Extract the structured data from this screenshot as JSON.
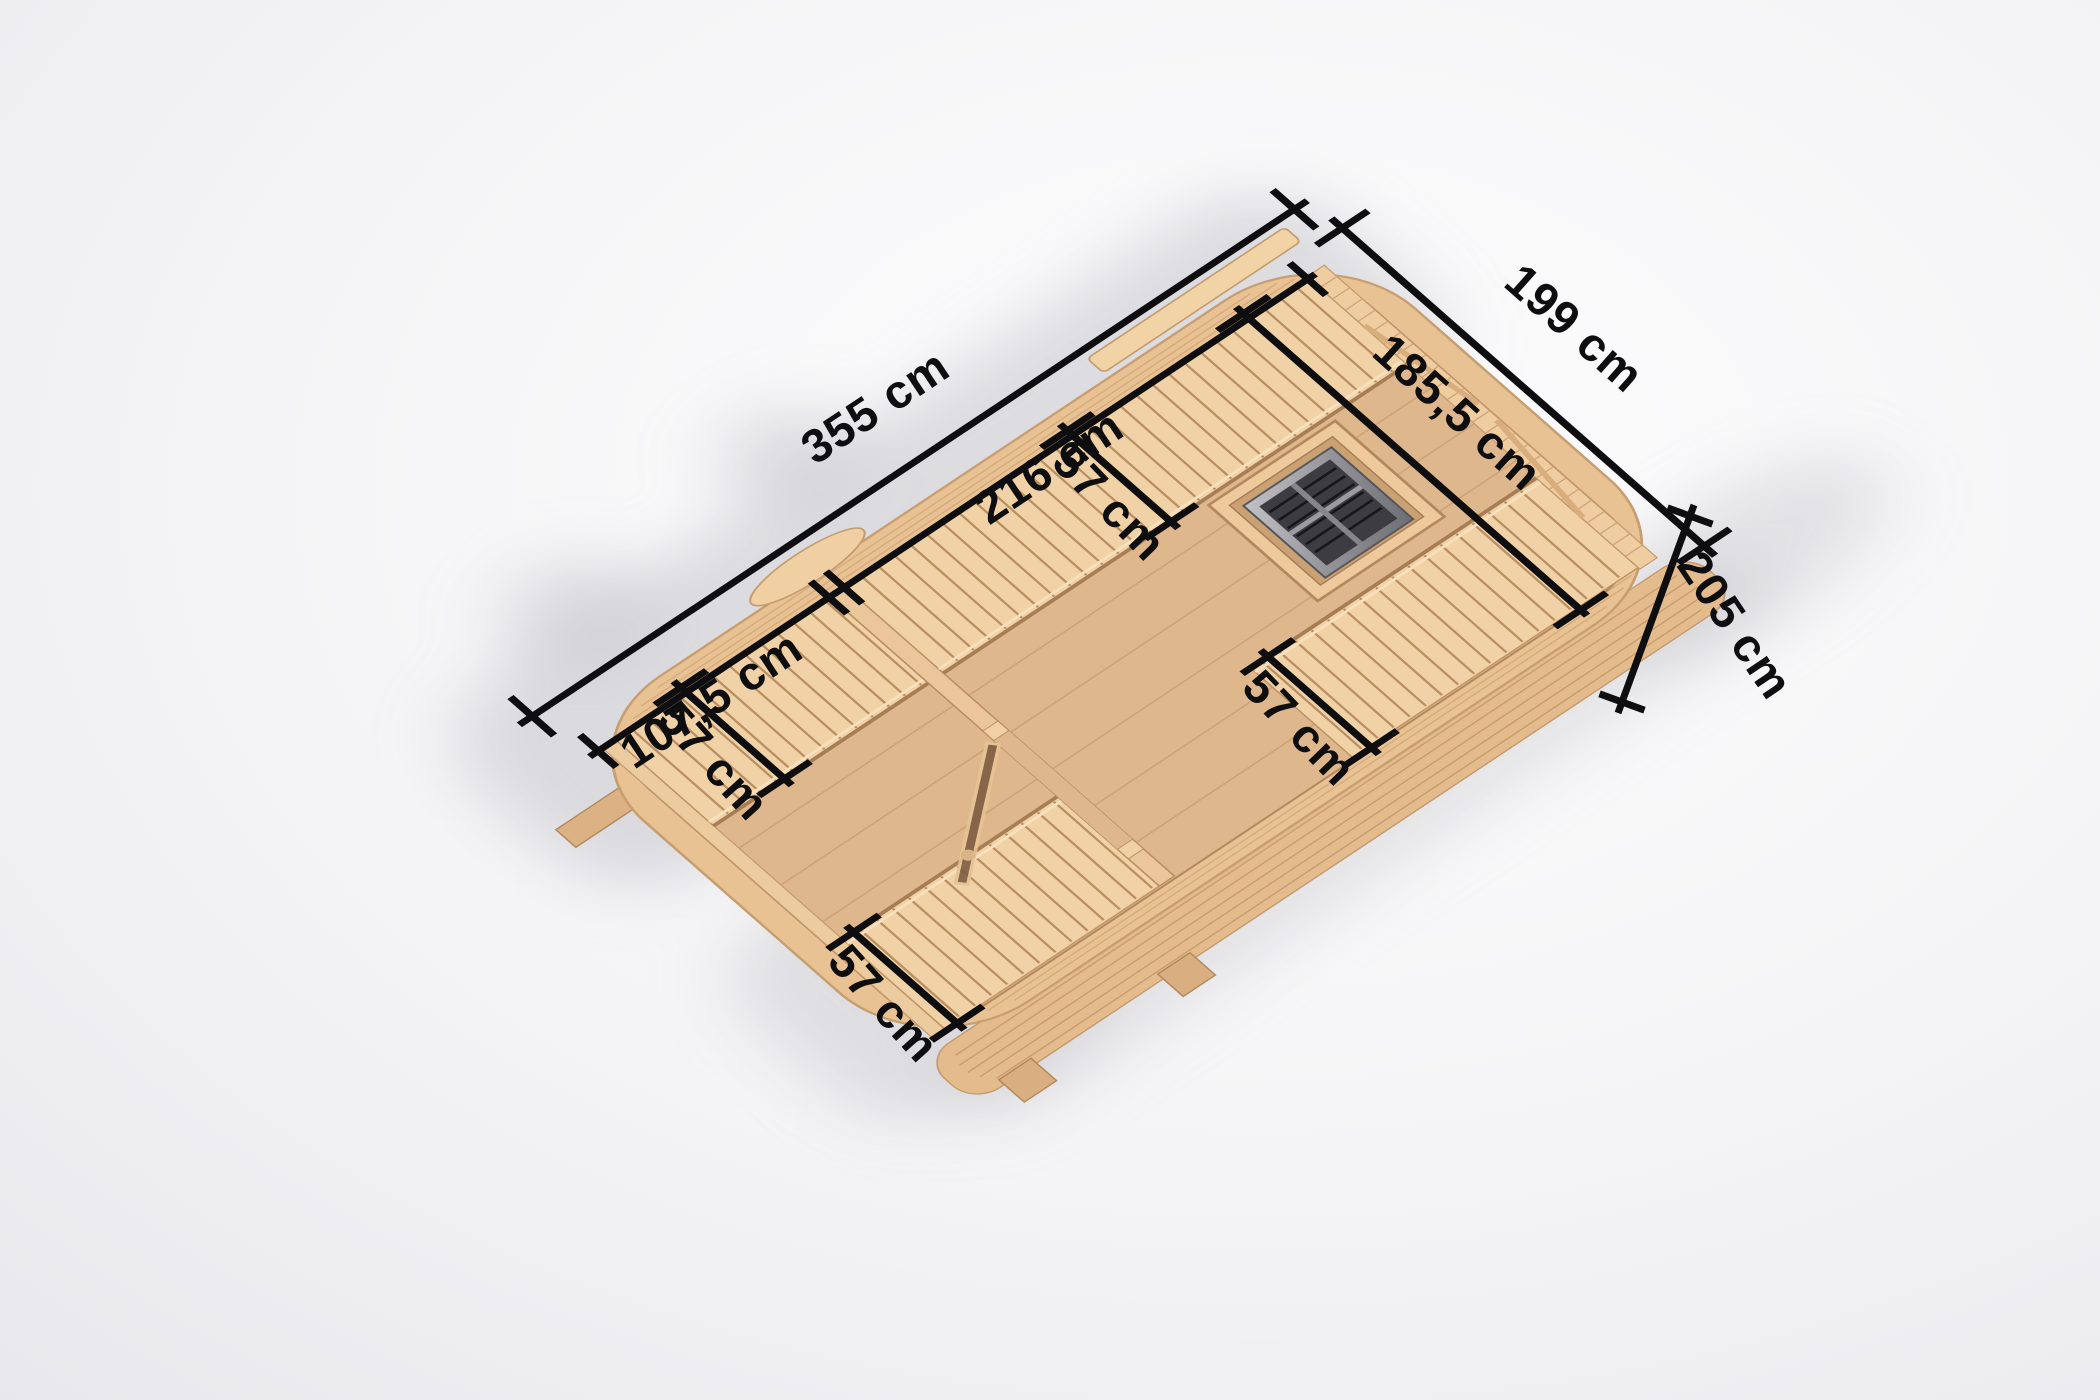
{
  "scene": {
    "title": "Barrel sauna top view with interior dimensions",
    "view": "top-down cutaway product render",
    "background_color": "#f1f1f4",
    "dimension_line_color": "#0e0e10",
    "wood_color": "#e9c294",
    "bench_color": "#f1d2a6",
    "floor_color": "#dfb78c",
    "heater_metal_color": "#8a8a90",
    "door_glass_color": "#7b5a40"
  },
  "dimensions": {
    "overall_length": {
      "label": "355 cm"
    },
    "overall_end_width": {
      "label": "199 cm"
    },
    "overall_side_width": {
      "label": "205 cm"
    },
    "sauna_room_length": {
      "label": "216 cm"
    },
    "sauna_room_width": {
      "label": "185,5 cm"
    },
    "changing_room_length": {
      "label": "107,5 cm"
    },
    "bench_depths": [
      {
        "area": "sauna-room-top-bench",
        "label": "57 cm"
      },
      {
        "area": "sauna-room-side-bench",
        "label": "57 cm"
      },
      {
        "area": "changing-room-top-bench",
        "label": "57 cm"
      },
      {
        "area": "changing-room-side-bench",
        "label": "57 cm"
      }
    ]
  }
}
